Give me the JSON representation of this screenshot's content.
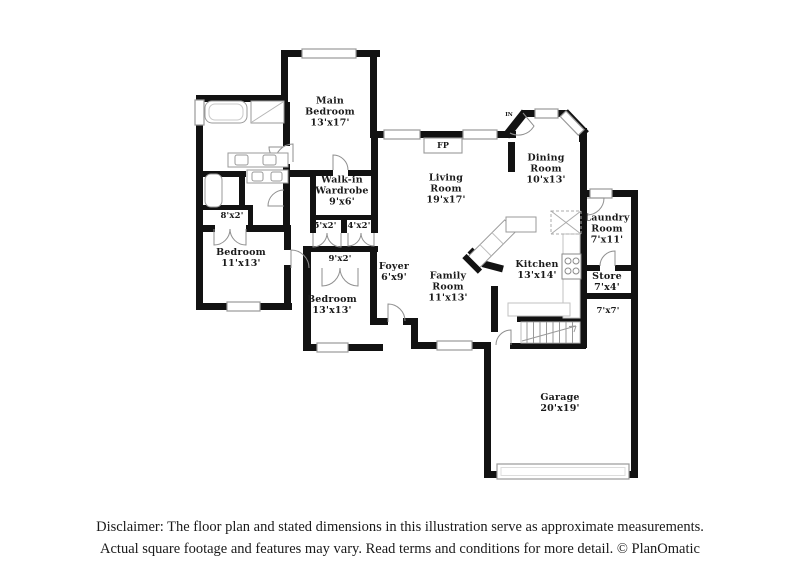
{
  "rooms": {
    "main_bedroom": {
      "name": "Main\nBedroom",
      "dims": "13'x17'"
    },
    "walk_in_wardrobe": {
      "name": "Walk-in\nWardrobe",
      "dims": "9'x6'"
    },
    "living_room": {
      "name": "Living\nRoom",
      "dims": "19'x17'"
    },
    "dining_room": {
      "name": "Dining\nRoom",
      "dims": "10'x13'"
    },
    "laundry_room": {
      "name": "Laundry\nRoom",
      "dims": "7'x11'"
    },
    "kitchen": {
      "name": "Kitchen",
      "dims": "13'x14'"
    },
    "store": {
      "name": "Store",
      "dims": "7'x4'"
    },
    "bedroom_left": {
      "name": "Bedroom",
      "dims": "11'x13'"
    },
    "bedroom_middle": {
      "name": "Bedroom",
      "dims": "13'x13'"
    },
    "foyer": {
      "name": "Foyer",
      "dims": "6'x9'"
    },
    "family_room": {
      "name": "Family\nRoom",
      "dims": "11'x13'"
    },
    "garage": {
      "name": "Garage",
      "dims": "20'x19'"
    }
  },
  "closets": {
    "c8x2": "8'x2'",
    "c5x2": "5'x2'",
    "c4x2": "4'x2'",
    "c9x2": "9'x2'",
    "c7x7": "7'x7'"
  },
  "markers": {
    "fireplace": "FP",
    "entry": "IN"
  },
  "disclaimer": {
    "line1": "Disclaimer: The floor plan and stated dimensions in this illustration serve as approximate measurements.",
    "line2": "Actual square footage and features may vary. Read terms and conditions for more detail. © PlanOmatic"
  },
  "colors": {
    "wall": "#121212",
    "window_border": "#999999",
    "fixture_line": "#9a9a9a",
    "text": "#1a1a1a"
  }
}
